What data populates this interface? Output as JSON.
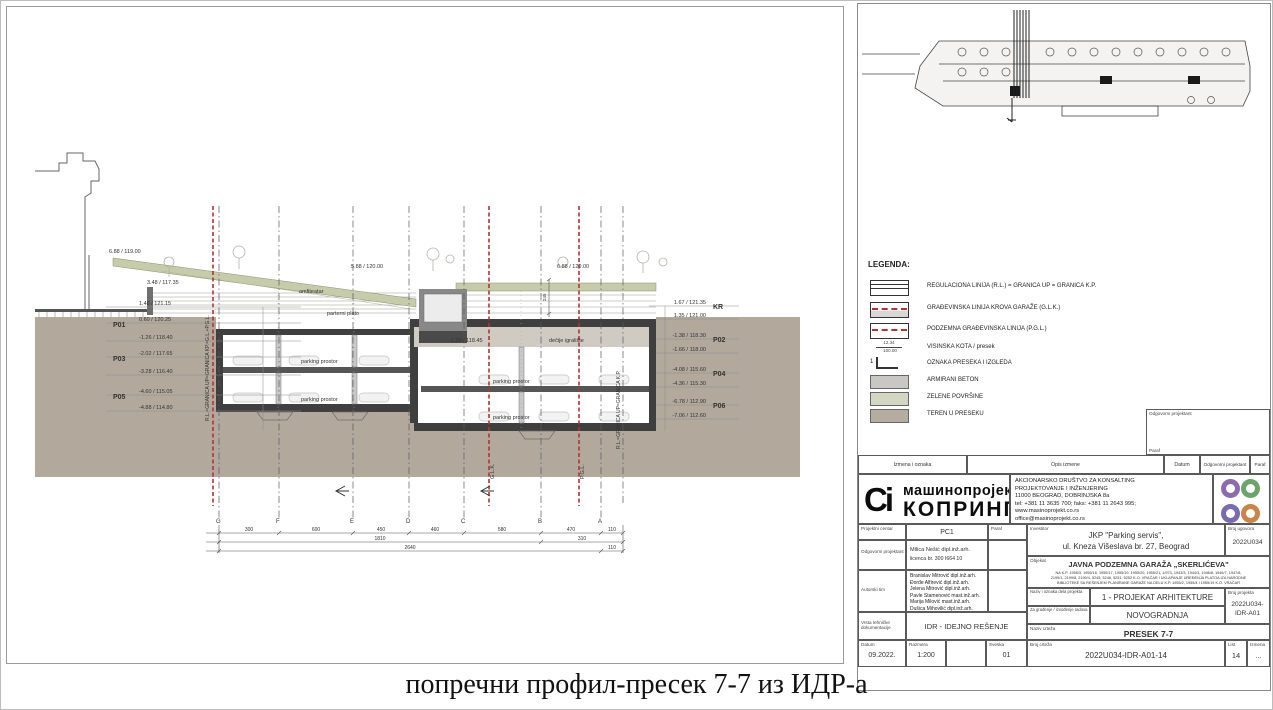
{
  "caption": "попречни профил-пресек 7-7 из ИДР-а",
  "drawing": {
    "levels_left": [
      {
        "p": "",
        "elev": "1.48 / 121.15"
      },
      {
        "p": "P01",
        "elev": "0.60 / 120.25"
      },
      {
        "p": "",
        "elev": "-1.26 / 118.40"
      },
      {
        "p": "P03",
        "elev": "-2.02 / 117.65"
      },
      {
        "p": "",
        "elev": "-3.28 / 116.40"
      },
      {
        "p": "P05",
        "elev": "-4.60 / 115.05"
      },
      {
        "p": "",
        "elev": "-4.88 / 114.80"
      }
    ],
    "levels_right": [
      {
        "p": "KR",
        "elev": "1.67 / 121.35"
      },
      {
        "p": "",
        "elev": "1.35 / 121.00"
      },
      {
        "p": "P02",
        "elev": "-1.38 / 118.30"
      },
      {
        "p": "",
        "elev": "-1.66 / 118.00"
      },
      {
        "p": "P04",
        "elev": "-4.08 / 115.60"
      },
      {
        "p": "",
        "elev": "-4.36 / 115.30"
      },
      {
        "p": "P06",
        "elev": "-6.78 / 112.90"
      },
      {
        "p": "",
        "elev": "-7.06 / 112.60"
      }
    ],
    "top_elevations": [
      "6.88 / 119.00",
      "3.48 / 117.35",
      "5.88 / 120.00",
      "6.88 / 120.00",
      "-1.20 / 118.45"
    ],
    "labels": {
      "amfiteatar": "amfiteatar",
      "parterni_plato": "parterni plato",
      "decije_igraliste": "dečije igralište",
      "parking": "parking prostor"
    },
    "boundary_left": "R.L.=GRANICA UP=GRANICA KP.=G.L.+P.G.L.",
    "boundary_right": "R.L.=GRANICA UP=GRANICA K.P.",
    "glk": "G.L.K.",
    "pgl": "P.G.L.",
    "kr": "KR",
    "deck_dim": "245",
    "grid_letters": [
      "G",
      "F",
      "E",
      "D",
      "C",
      "B",
      "A"
    ],
    "dims_row1": [
      "300",
      "600",
      "450",
      "460",
      "580",
      "470",
      "110"
    ],
    "dims_row2": [
      "1810",
      "310"
    ],
    "dims_row3": [
      "2640",
      "110"
    ]
  },
  "legend": {
    "title": "LEGENDA:",
    "items": [
      {
        "label": "REGULACIONA LINIJA (R.L.) = GRANICA UP = GRANICA K.P."
      },
      {
        "label": "GRAĐEVINSKA LINIJA KROVA GARAŽE (G.L.K.)"
      },
      {
        "label": "PODZEMNA GRAĐEVINSKA LINIJA (P.G.L.)"
      },
      {
        "label": "VISINSKA KOTA / presek",
        "kota_top": "12.34",
        "kota_bottom": "100.00"
      },
      {
        "label": "OZNAKA PRESEKA I IZGLEDA",
        "mark": "1"
      },
      {
        "label": "ARMIRANI BETON",
        "color": "#c9c7c3"
      },
      {
        "label": "ZELENE POVRŠINE",
        "color": "#d3d6c2"
      },
      {
        "label": "TEREN U PRESEKU",
        "color": "#b5ada0"
      }
    ]
  },
  "title_block": {
    "approver_box": {
      "label": "Odgovorni projektant",
      "paraf": "Paraf"
    },
    "revision_header": [
      "Izmena i oznaka",
      "Opis izmene",
      "Datum",
      "Odgovorni projektant",
      "Paraf"
    ],
    "logo": {
      "mark": "Ci",
      "line1": "машинопројект",
      "line2": "КОПРИНГ"
    },
    "company_info": [
      "AKCIONARSKO DRUŠTVO ZA KONSALTING",
      "PROJEKTOVANJE I INŽENJERING",
      "11000 BEOGRAD, DOBRINJSKA 8a",
      "tel: +381 11 3635 700; faks: +381 11 2643 995;",
      "www.masinoprojekt.co.rs",
      "office@masinoprojekt.co.rs"
    ],
    "fields": {
      "projektni_centar_label": "Projektni centar",
      "projektni_centar": "PC1",
      "paraf_label": "Paraf",
      "odgovorni_projektant_label": "Odgovorni projektant",
      "odgovorni_projektant": "Milica Nešić dipl.inž.arh.",
      "licenca": "licenca br. 300 I664 10",
      "autorski_tim_label": "Autorski tim",
      "autorski_tim": [
        "Branislav Mitrović dipl.inž.arh.",
        "Đorđe Alfirević dipl.inž.arh.",
        "Jelena Mitrović dipl.inž.arh.",
        "Pavle Stamenović mast.inž.arh.",
        "Marija Milović mast.inž.arh.",
        "Dušica Mihovilić dipl.inž.arh."
      ],
      "vrsta_label": "Vrsta tehničke dokumentacije",
      "vrsta": "IDR - IDEJNO REŠENJE",
      "investitor_label": "Investitor",
      "investitor1": "JKP \"Parking servis\",",
      "investitor2": "ul. Kneza Višeslava br. 27, Beograd",
      "broj_ugovora_label": "Broj ugovora",
      "broj_ugovora": "2022U034",
      "objekat_label": "Objekat",
      "objekat": "JAVNA PODZEMNA GARAŽA „SKERLIĆEVA\"",
      "objekat_detail1": "NA K.P. 1955/3, 1955/16, 1955/17, 1955/19, 1955/20, 1955/21, 1/973, 1943/3, 1944/3, 1946/8, 1946/7, 1947/8,",
      "objekat_detail2": "2199/1, 2199/8, 2199/4, 5245, 5246, 5251, 5252 K.O. VRAČAR I UKLAPANJE UREĐENJA PLATOA IZA NARODNE",
      "objekat_detail3": "BIBLIOTEKE SA REŠENJEM PLANIRANE GARAŽE NA DELU K.P. 1955/2, 1955/4 I 1955/19 K.O. VRAČAR",
      "naziv_dela_label": "Naziv i oznaka dela projekta",
      "naziv_dela": "1 - PROJEKAT ARHITEKTURE",
      "broj_projekta_label": "Broj projekta",
      "broj_projekta1": "2022U034-",
      "broj_projekta2": "IDR-A01",
      "za_gradjenje_label": "Za građenje / izvođenje radova",
      "za_gradjenje": "NOVOGRADNJA",
      "naziv_crteza_label": "Naziv crteža",
      "naziv_crteza": "PRESEK 7-7",
      "datum_label": "Datum",
      "datum": "09.2022.",
      "razmera_label": "Razmera",
      "razmera": "1:200",
      "sveska_label": "Sveska",
      "sveska": "01",
      "broj_crteza_label": "Broj crteža",
      "broj_crteza": "2022U034-IDR-A01-14",
      "list_label": "List",
      "list": "14",
      "izmena_label": "Izmena",
      "izmena": "..."
    },
    "stamp_colors": [
      "#8b6bb1",
      "#6aa56a",
      "#7a6bb1",
      "#c98448"
    ]
  },
  "colors": {
    "terrain": "#b2a99c",
    "green": "#c6cbaa",
    "slab": "#3f3f3f",
    "red_line": "#b13434"
  }
}
